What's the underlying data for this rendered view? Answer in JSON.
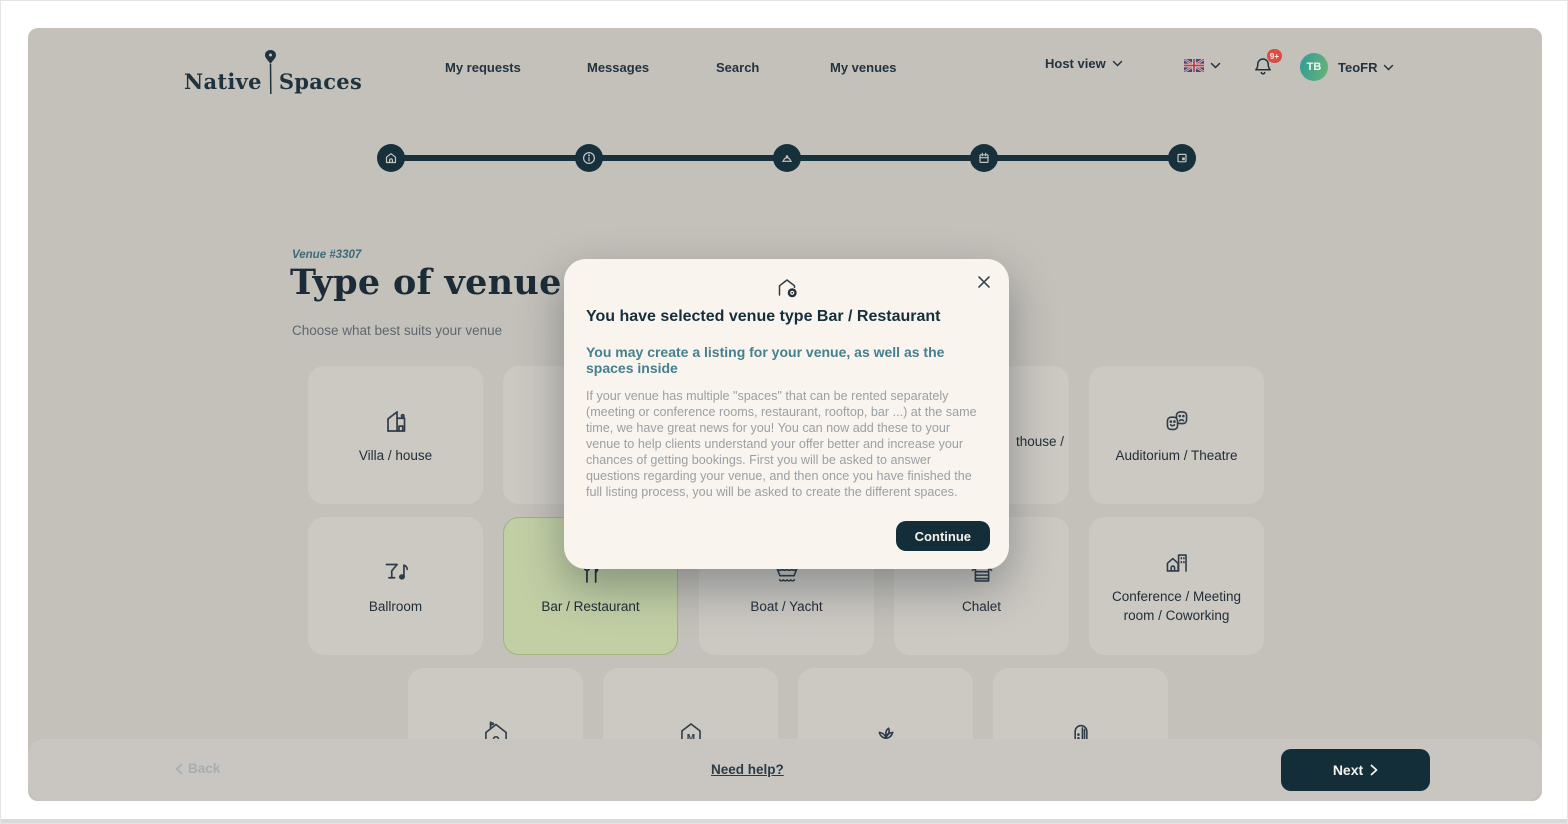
{
  "nav": {
    "logo_part1": "Native",
    "logo_part2": "Spaces",
    "items": [
      "My requests",
      "Messages",
      "Search",
      "My venues"
    ],
    "host_view_label": "Host view",
    "notification_badge": "9+",
    "avatar_initials": "TB",
    "user_name": "TeoFR"
  },
  "stepper": {
    "step_icons": [
      "house",
      "info",
      "cloche",
      "calendar",
      "picture-card"
    ]
  },
  "heading": {
    "venue_ref": "Venue #3307",
    "title": "Type of venue",
    "subtitle": "Choose what best suits your venue"
  },
  "cards": {
    "row1": [
      {
        "label": "Villa / house",
        "icon": "modern-house"
      },
      {
        "label": ""
      },
      {
        "label": ""
      },
      {
        "label": "",
        "fragment": "thouse /"
      },
      {
        "label": "Auditorium / Theatre",
        "icon": "theatre-masks"
      }
    ],
    "row2": [
      {
        "label": "Ballroom",
        "icon": "martini-music-note"
      },
      {
        "label": "Bar / Restaurant",
        "icon": "fork-knife",
        "selected": true
      },
      {
        "label": "Boat / Yacht",
        "icon": "boat-waves"
      },
      {
        "label": "Chalet",
        "icon": "log-cabin"
      },
      {
        "label": "Conference / Meeting room / Coworking",
        "icon": "house-office-building"
      }
    ],
    "row3": [
      {
        "label": "",
        "icon": "house-flag"
      },
      {
        "label": "",
        "icon": "museum"
      },
      {
        "label": "",
        "icon": "plant"
      },
      {
        "label": "",
        "icon": "arched-hall"
      }
    ]
  },
  "modal": {
    "icon": "house-add",
    "title": "You have selected venue type Bar / Restaurant",
    "subtitle": "You may create a listing for your venue, as well as the spaces inside",
    "body": "If your venue has multiple \"spaces\" that can be rented separately (meeting or conference rooms, restaurant, rooftop, bar ...) at the same time, we have great news for you! You can now add these to your venue to help clients understand your offer better and increase your chances of getting bookings. First you will be asked to answer questions regarding your venue, and then once you have finished the full listing process, you will be asked to create the different spaces.",
    "continue_label": "Continue"
  },
  "footer": {
    "back_label": "Back",
    "help_label": "Need help?",
    "next_label": "Next"
  },
  "colors": {
    "accent_navy": "#16313c",
    "selected_green": "#c2cfa5",
    "badge_red": "#da4c45",
    "subtitle_teal": "#45808f",
    "modal_cream": "#f9f4ed"
  }
}
